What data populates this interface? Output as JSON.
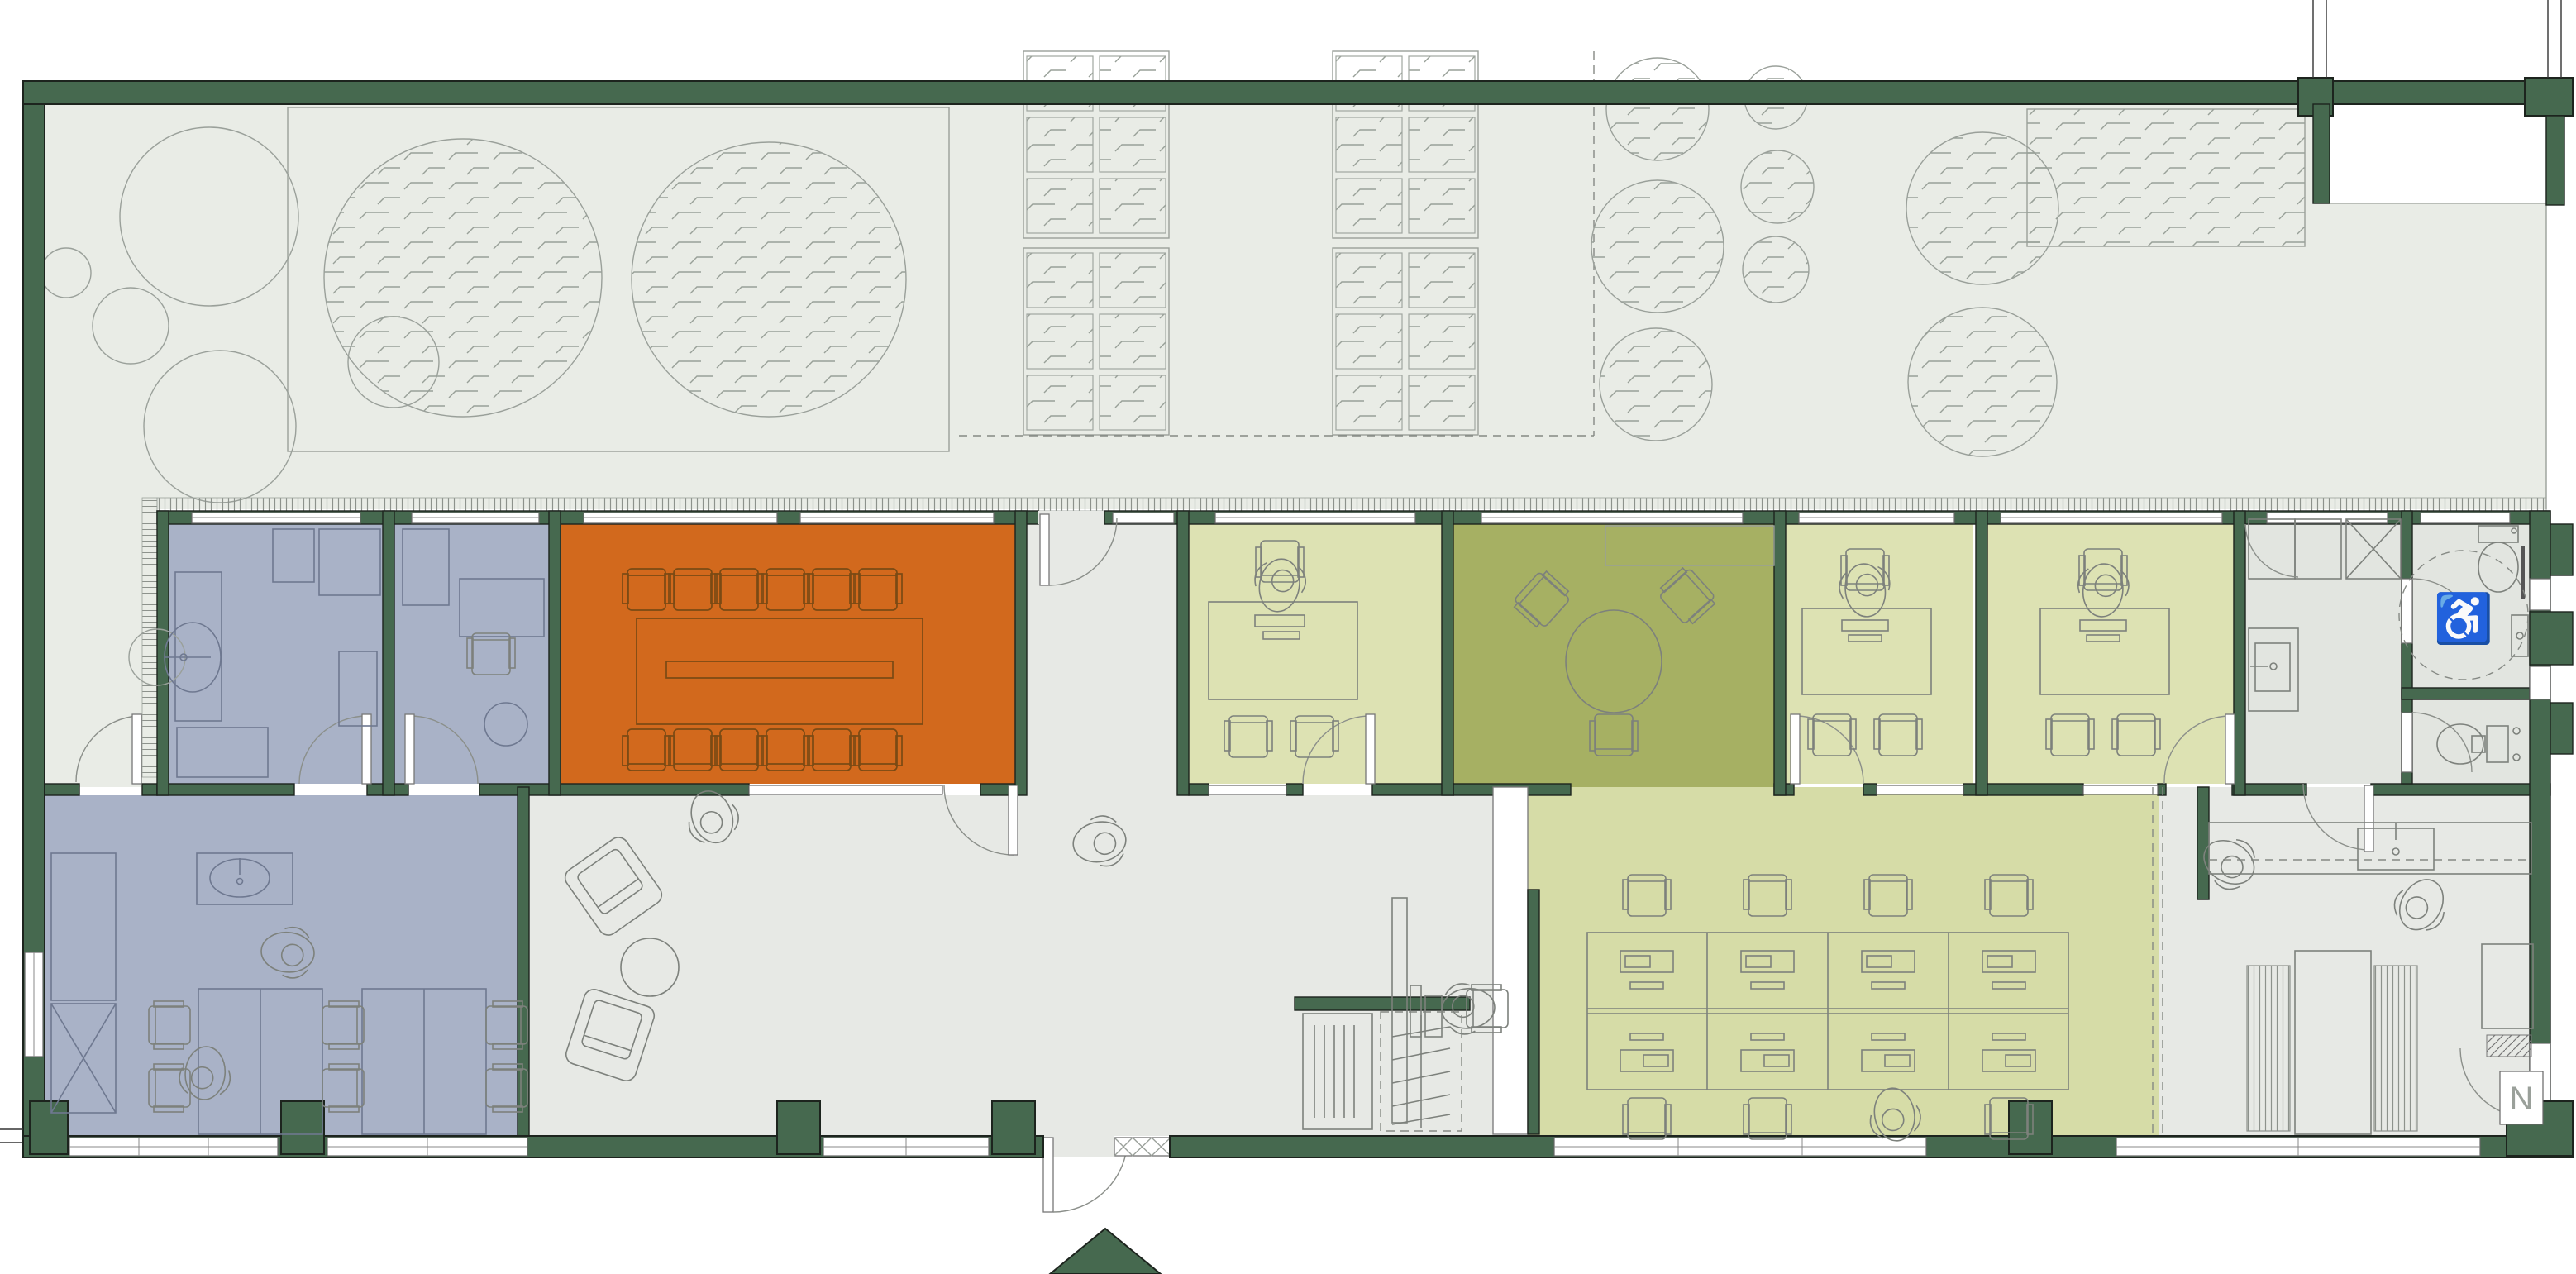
{
  "document": {
    "type": "architectural floor plan",
    "description": "Top-down office floor plan with roof terrace garden, entrance arrow at bottom",
    "visible_text_note": "plan contains no room labels; only a wheelchair accessibility symbol and an N sign are visible"
  },
  "palette": {
    "wall": "#46694F",
    "wall_outline": "#1d241e",
    "terrace": "#E9ECE6",
    "floor_gray": "#E7E9E5",
    "floor_bath": "#E2E5E0",
    "room_blue": "#A9B2C7",
    "room_orange": "#D2691D",
    "room_green_light": "#DDE2B3",
    "room_olive": "#A6B063",
    "room_open_office": "#D6DCA7",
    "line": "#7D817C",
    "line_light": "#9AA09A",
    "line_blue": "#6E7890",
    "line_orange": "#7A4A14",
    "white": "#FFFFFF"
  },
  "signs": {
    "wheelchair_symbol": "♿",
    "north_sign": "N"
  },
  "legend": [
    {
      "name": "structural walls / columns",
      "color": "#46694F"
    },
    {
      "name": "roof terrace with trees and planters",
      "color": "#E9ECE6"
    },
    {
      "name": "private offices / lounge (blue)",
      "color": "#A9B2C7"
    },
    {
      "name": "conference room (orange)",
      "color": "#D2691D"
    },
    {
      "name": "meeting room (olive)",
      "color": "#A6B063"
    },
    {
      "name": "offices (light green)",
      "color": "#DDE2B3"
    },
    {
      "name": "open office (pale green)",
      "color": "#D6DCA7"
    },
    {
      "name": "circulation / lobby / WC / kitchen (gray)",
      "color": "#E7E9E5"
    }
  ],
  "counts": {
    "conference_chairs": 12,
    "open_office_workstations": 8,
    "meeting_table_chairs": 3,
    "planter_clusters": 4,
    "hatched_trees_large": 2,
    "people_figures": 11
  }
}
